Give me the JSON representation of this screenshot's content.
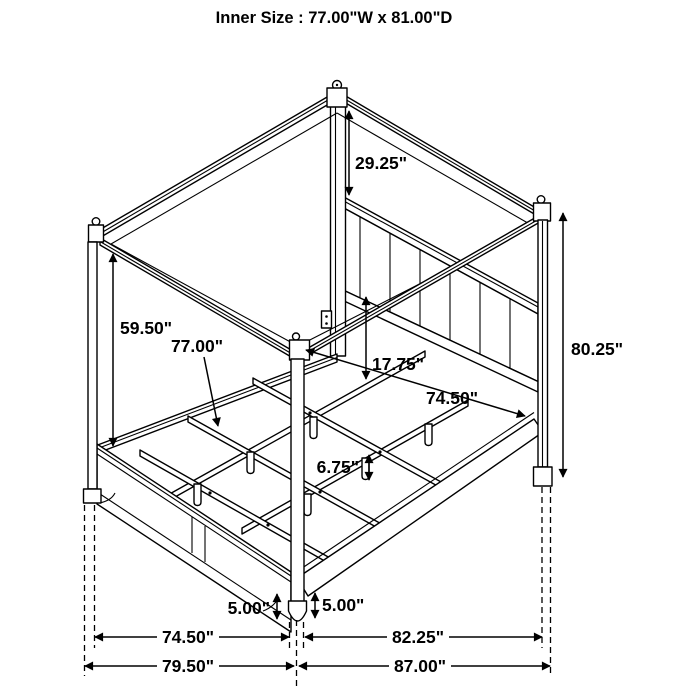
{
  "title": "Inner Size : 77.00\"W x 81.00\"D",
  "labels": {
    "canopy_drop": "29.25\"",
    "under_canopy_height": "59.50\"",
    "inner_width": "77.00\"",
    "rail_to_headboard": "17.75\"",
    "inner_depth": "74.50\"",
    "post_height": "80.25\"",
    "center_leg_height": "6.75\"",
    "footboard_floor_clearance": "5.00\"",
    "rail_floor_clearance": "5.00\"",
    "footboard_width": "74.50\"",
    "side_length": "82.25\"",
    "overall_width": "79.50\"",
    "overall_depth": "87.00\""
  }
}
